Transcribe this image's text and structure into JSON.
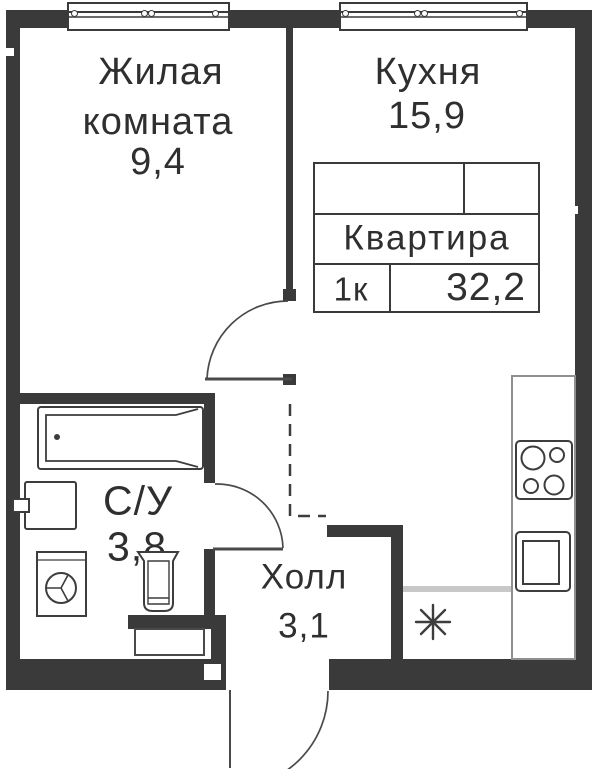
{
  "plan_type": "apartment-floor-plan",
  "labels": {
    "living_line1": "Жилая",
    "living_line2": "комната",
    "living_area": "9,4",
    "kitchen_name": "Кухня",
    "kitchen_area": "15,9",
    "bathroom_name": "С/У",
    "bathroom_area": "3,8",
    "hall_name": "Холл",
    "hall_area": "3,1"
  },
  "info_table": {
    "title": "Квартира",
    "rooms_value": "1к",
    "total_area_value": "32,2"
  },
  "fixtures": [
    "window",
    "bathtub",
    "bath-sink",
    "washing-machine",
    "toilet",
    "stove-4-burners",
    "kitchen-sink",
    "vent-asterisk",
    "door-swing-living",
    "door-swing-bathroom",
    "door-swing-entrance",
    "dashed-opening"
  ],
  "colors": {
    "wall": "#3a3a3a",
    "line": "#3d3d3d",
    "light_line": "#c8c8c8",
    "counter_border": "#8f8f8f",
    "text": "#2f2f2f",
    "background": "#ffffff"
  }
}
